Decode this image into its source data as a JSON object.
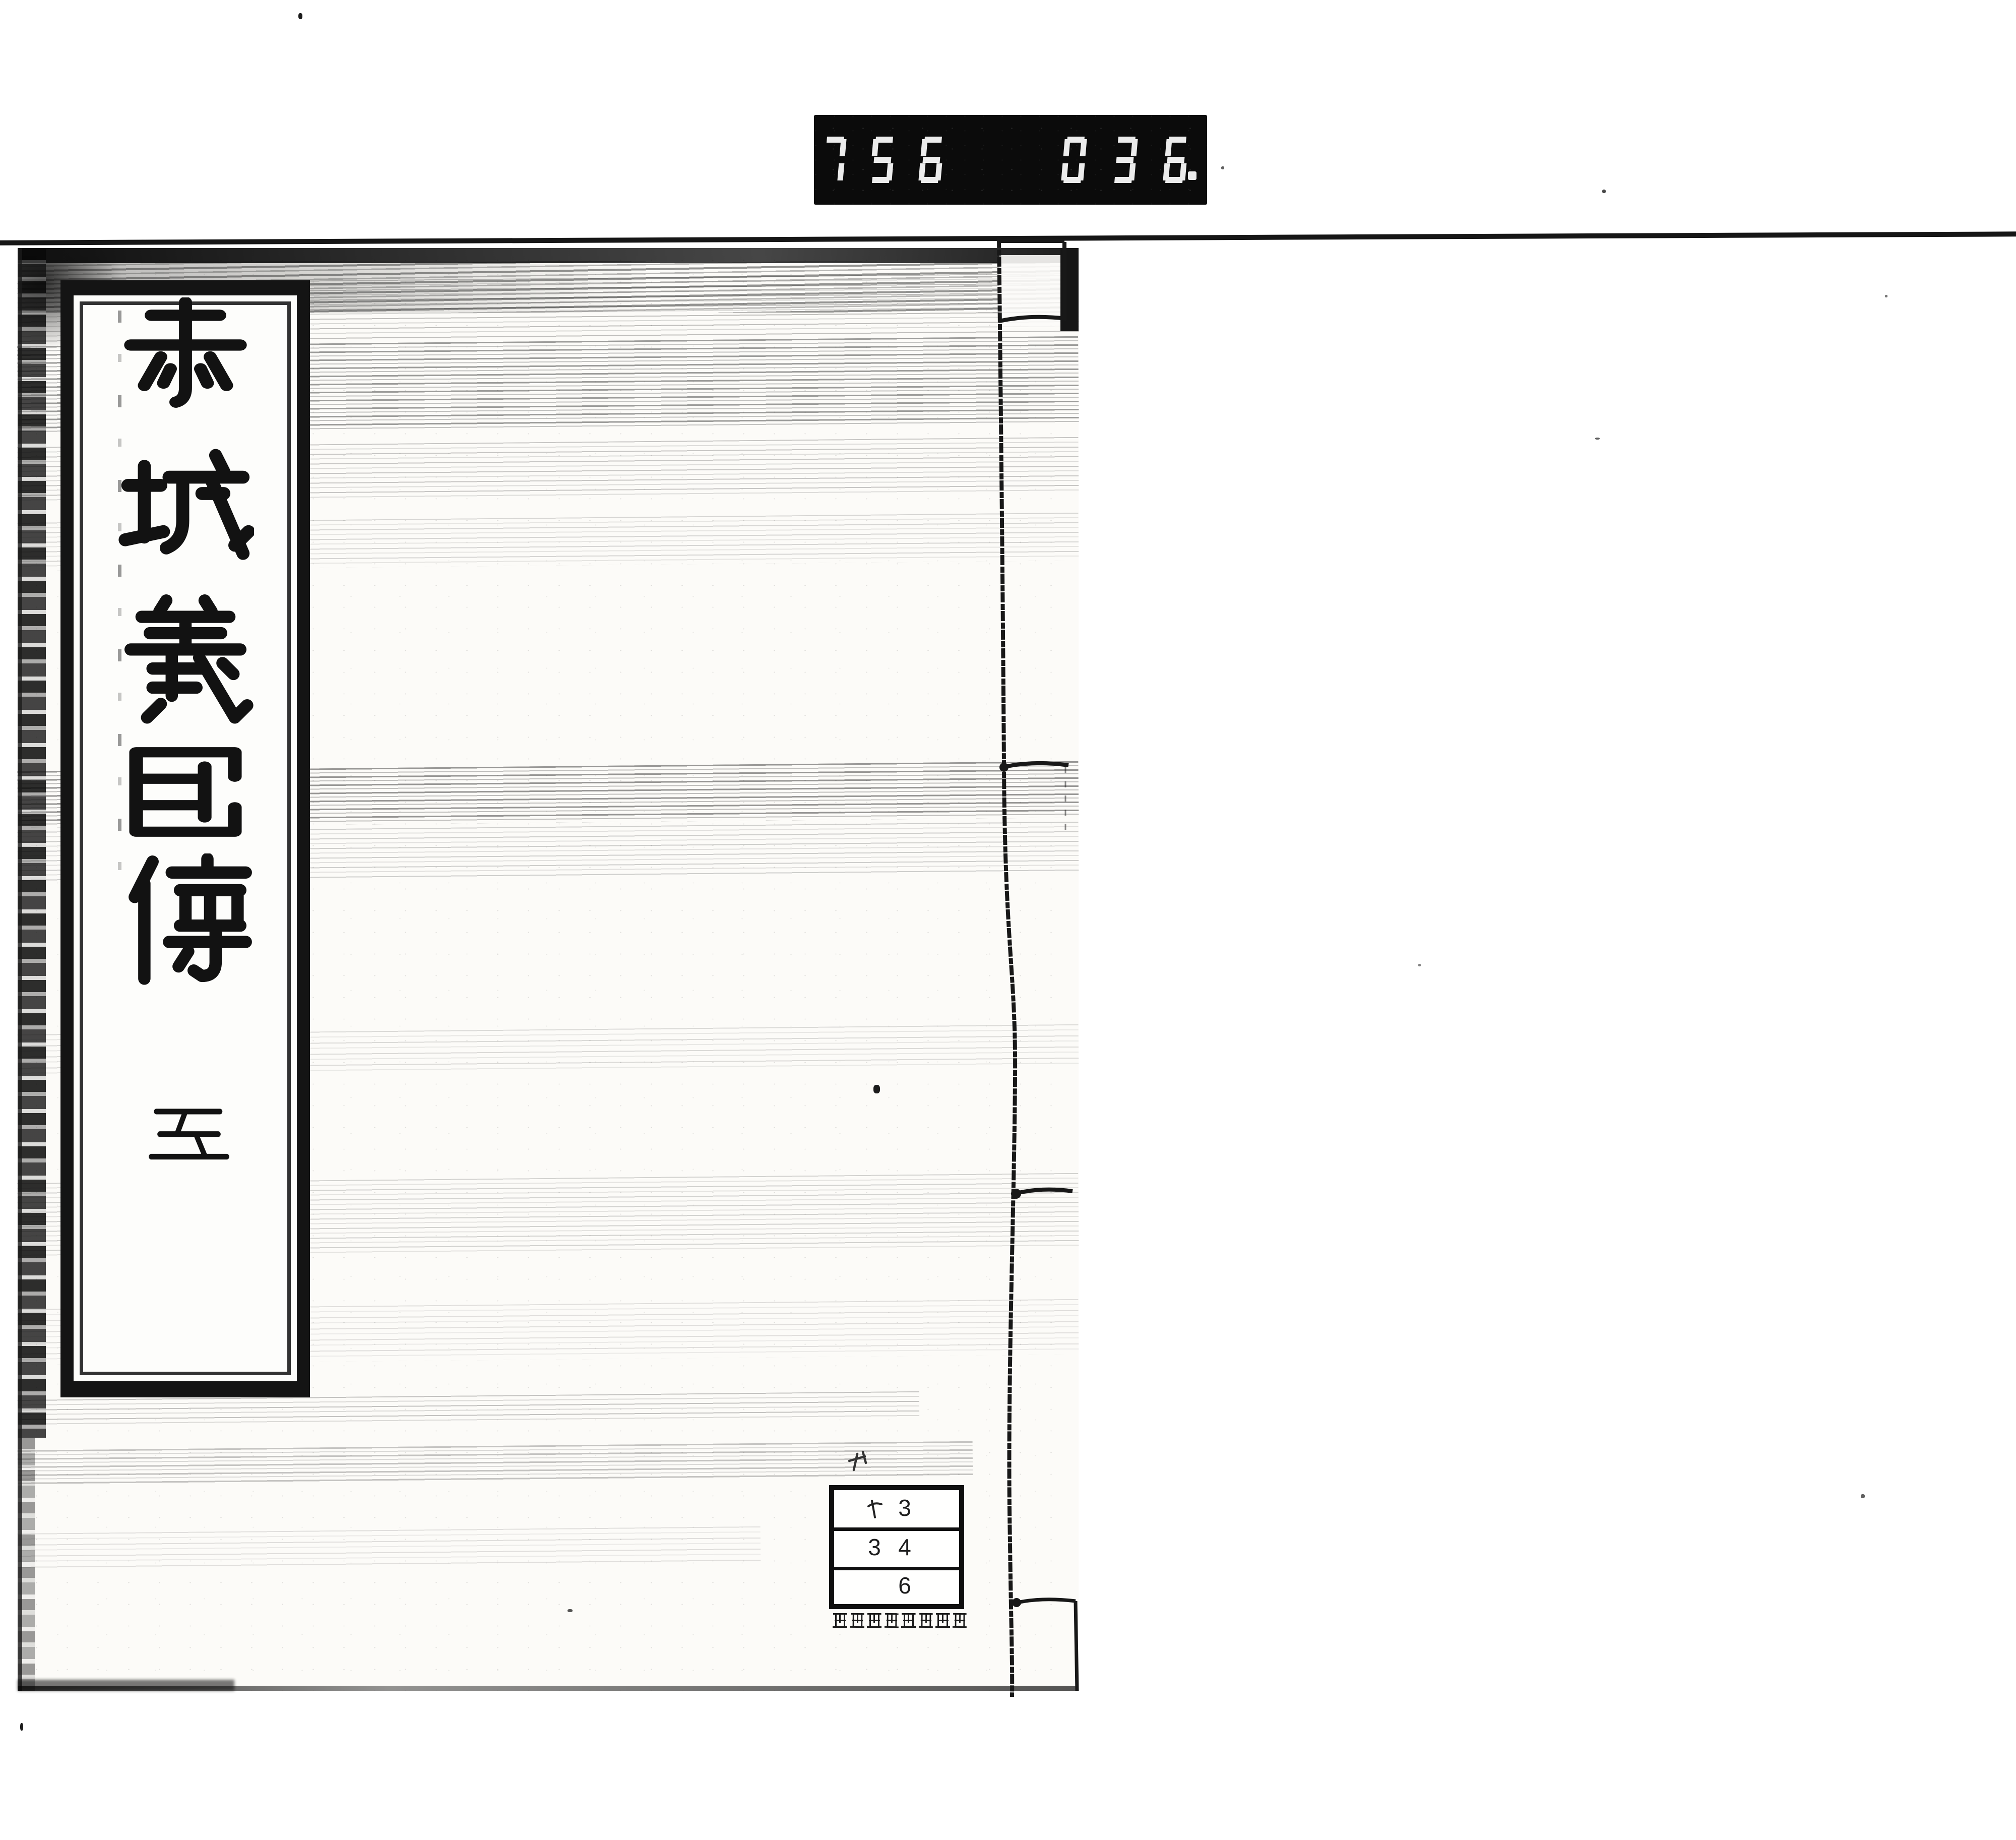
{
  "page": {
    "background": "#ffffff"
  },
  "film_counter": {
    "left_digits": "756",
    "right_digits": "036",
    "trailing_dot": true,
    "display_background": "#0b0b0b",
    "digit_color": "#ececec"
  },
  "book_cover": {
    "title_slip": {
      "title": "赤城義臣傳",
      "volume": "五"
    },
    "ink_color": "#141414",
    "paper_color": "#fcfbf8"
  },
  "call_number_label": {
    "rows": [
      {
        "kana": "ヤ",
        "number": "3"
      },
      {
        "left_number": "3",
        "right_number": "4"
      },
      {
        "number": "6"
      }
    ]
  },
  "institution_stamp": {
    "text": "国文学研究資料館"
  }
}
